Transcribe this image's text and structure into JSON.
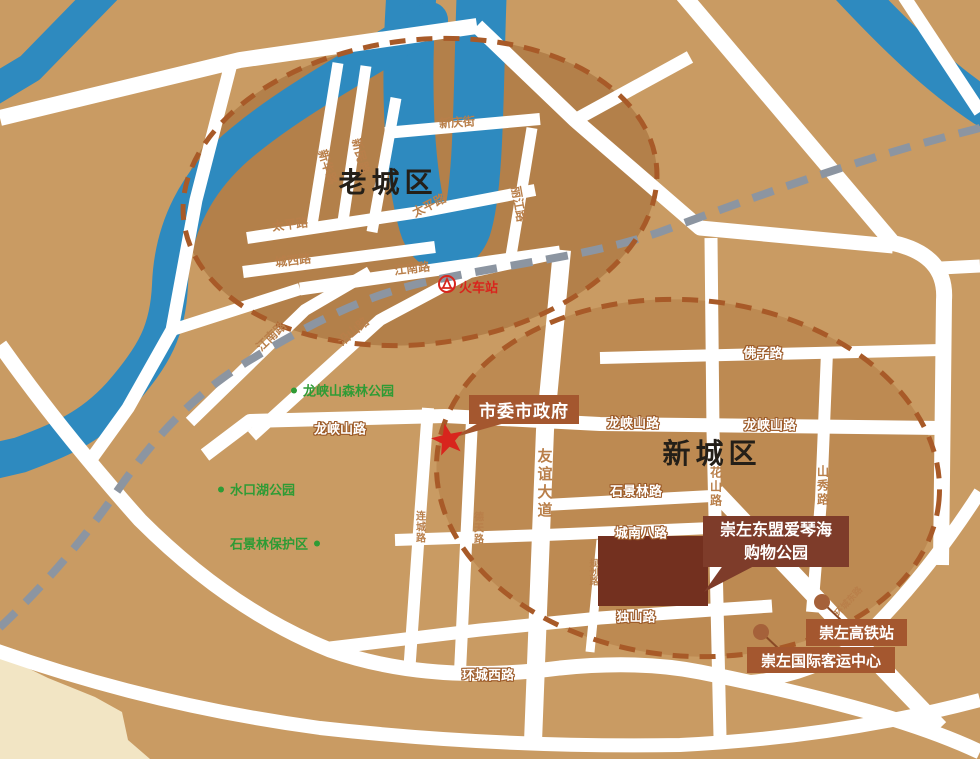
{
  "title": "崇左城区示意图",
  "colors": {
    "land": "#c99b63",
    "old_district_block": "#b3804a",
    "new_district_block": "#bd8a52",
    "lowland": "#f2e5c4",
    "river": "#2e8abf",
    "road": "#ffffff",
    "railway": "#8c95a1",
    "boundary_dash": "#a85a28",
    "park_green": "#2f9b35",
    "road_label_brown": "#b97f4a",
    "poi_box": "#a4572f",
    "poi_box_dark": "#7e3c2a",
    "building": "#73301f",
    "star_red": "#d8251d"
  },
  "districts": {
    "old": "老城区",
    "new": "新城区"
  },
  "parks": [
    {
      "name": "龙峡山森林公园"
    },
    {
      "name": "水口湖公园"
    },
    {
      "name": "石景林保护区"
    }
  ],
  "pois": {
    "government": "市委市政府",
    "train_station": "火车站",
    "shopping_line1": "崇左东盟爱琴海",
    "shopping_line2": "购物公园",
    "hsr_station": "崇左高铁站",
    "bus_center": "崇左国际客运中心"
  },
  "road_labels": [
    {
      "text": "新华路"
    },
    {
      "text": "新民路"
    },
    {
      "text": "新庆街"
    },
    {
      "text": "太平路"
    },
    {
      "text": "太平路"
    },
    {
      "text": "城西路"
    },
    {
      "text": "江南路"
    },
    {
      "text": "丽江路"
    },
    {
      "text": "江南路"
    },
    {
      "text": "沿山路"
    },
    {
      "text": "龙峡山路"
    },
    {
      "text": "龙峡山路"
    },
    {
      "text": "龙峡山路"
    },
    {
      "text": "佛子路"
    },
    {
      "text": "石景林路"
    },
    {
      "text": "城南八路"
    },
    {
      "text": "独山路"
    },
    {
      "text": "环城西路"
    },
    {
      "text": "花山路"
    },
    {
      "text": "山秀路"
    },
    {
      "text": "连城路"
    },
    {
      "text": "德天路"
    },
    {
      "text": "友谊大道"
    },
    {
      "text": "规划路"
    },
    {
      "text": "环城东路"
    }
  ]
}
